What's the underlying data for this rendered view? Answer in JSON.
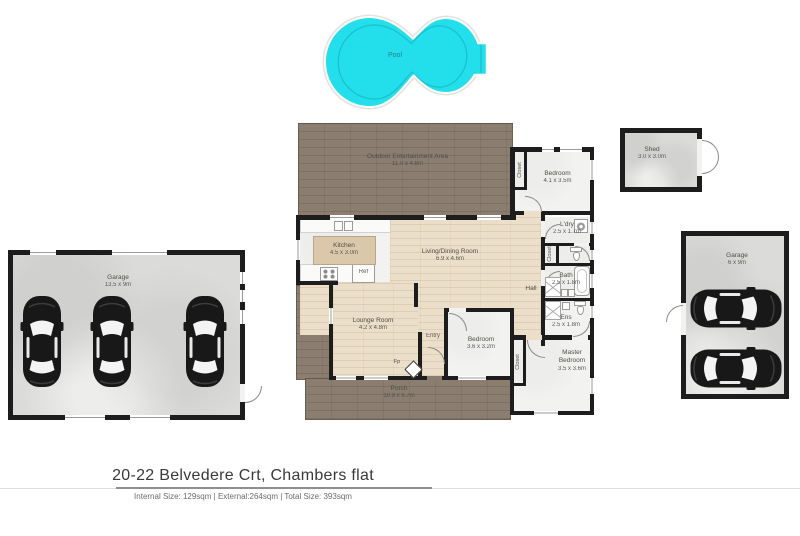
{
  "meta": {
    "address": "20-22 Belvedere Crt, Chambers flat",
    "sizes": "Internal Size: 129sqm | External:264sqm | Total Size: 393sqm"
  },
  "colors": {
    "pool": "#23dfeb",
    "deck": "#8b7d6f",
    "interior_wood": "#ecdfca",
    "room_floor": "#f2f2f0",
    "concrete": "#dbdbd9",
    "wall": "#1d1d1d"
  },
  "rooms": {
    "pool": {
      "label": "Pool"
    },
    "outdoor": {
      "label": "Outdoor Entertainment Area",
      "dims": "11.0 x 4.8m"
    },
    "shed": {
      "label": "Shed",
      "dims": "3.0 x 3.0m"
    },
    "garage_left": {
      "label": "Garage",
      "dims": "13.5 x 9m"
    },
    "garage_right": {
      "label": "Garage",
      "dims": "6 x 9m"
    },
    "bedroom_top": {
      "label": "Bedroom",
      "dims": "4.1 x 3.5m"
    },
    "laundry": {
      "label": "L'dry",
      "dims": "2.5 x 1.7m"
    },
    "bath": {
      "label": "Bath",
      "dims": "2.5 x 1.8m"
    },
    "ensuite": {
      "label": "Ens",
      "dims": "2.5 x 1.8m"
    },
    "master": {
      "label": "Master Bedroom",
      "dims": "3.5 x 3.6m"
    },
    "hall": {
      "label": "Hall"
    },
    "kitchen": {
      "label": "Kitchen",
      "dims": "4.5 x 3.0m"
    },
    "living": {
      "label": "Living/Dining Room",
      "dims": "6.9 x 4.6m"
    },
    "lounge": {
      "label": "Lounge Room",
      "dims": "4.2 x 4.8m"
    },
    "entry": {
      "label": "Entry"
    },
    "bedroom_mid": {
      "label": "Bedroom",
      "dims": "3.6 x 3.2m"
    },
    "porch": {
      "label": "Porch",
      "dims": "10.9 x 6.7m"
    },
    "closet": {
      "label": "Closet"
    },
    "fireplace": {
      "label": "Fp"
    },
    "fridge": {
      "label": "Ref"
    }
  }
}
